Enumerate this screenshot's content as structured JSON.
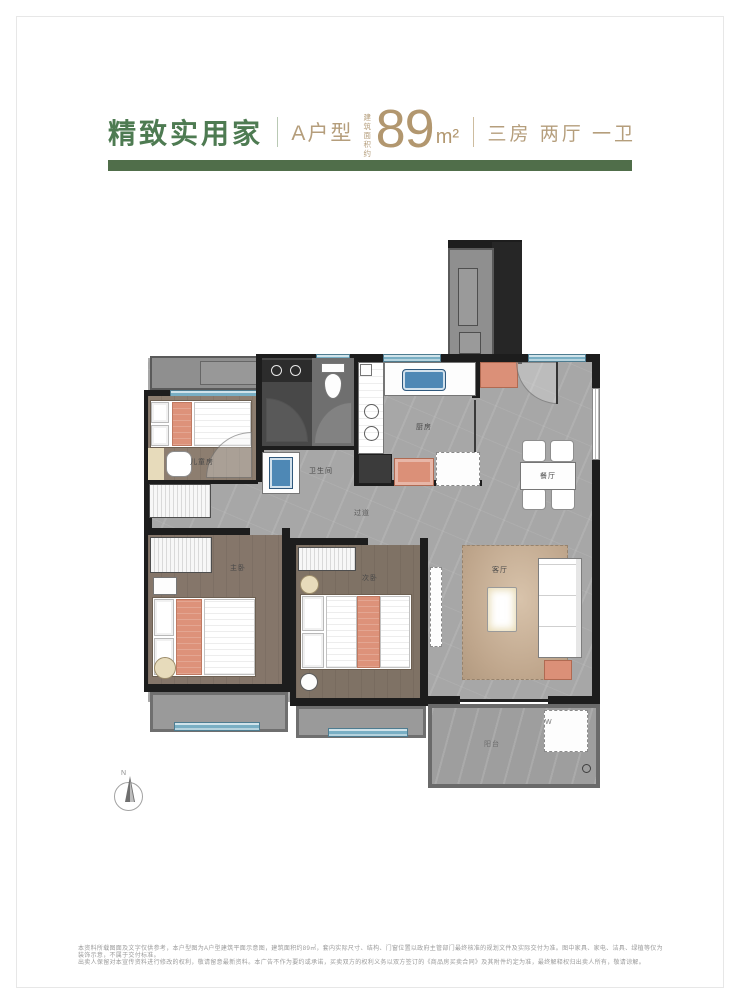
{
  "header": {
    "title": "精致实用家",
    "unit_label": "A户型",
    "area_prefix_line1": "建筑",
    "area_prefix_line2": "面积约",
    "area_value": "89",
    "area_unit": "m²",
    "layout_label": "三房 两厅 一卫",
    "title_color": "#4e7b52",
    "accent_color": "#b59e7c",
    "bar_color": "#506e4a"
  },
  "floorplan": {
    "rooms": {
      "bedroom_top": "儿童房",
      "master_bedroom": "主卧",
      "second_bedroom": "次卧",
      "kitchen": "厨房",
      "dining": "餐厅",
      "living": "客厅",
      "bathroom": "卫生间",
      "hallway": "过道",
      "balcony": "阳台"
    },
    "washer_label": "W",
    "compass_label": "N",
    "colors": {
      "wall": "#1d1d1d",
      "window_blue": "#79afc4",
      "furniture_salmon": "#db9078",
      "floor_marble_gray": "#a7a7a7",
      "floor_wood": "#85766a"
    }
  },
  "footer": {
    "disclaimer_line1": "本资料所载图面及文字仅供参考，本户型图为A户型建筑平面示意图，建筑面积约89㎡，套内实际尺寸、结构、门窗位置以政府主管部门最终核准的规划文件及实际交付为准。图中家具、家电、洁具、绿植等仅为装饰示意，不属于交付标准。",
    "disclaimer_line2": "出卖人保留对本宣传资料进行修改的权利，敬请留意最新资料。本广告不作为要约或承诺，买卖双方的权利义务以双方签订的《商品房买卖合同》及其附件约定为准，最终解释权归出卖人所有，敬请谅解。"
  }
}
